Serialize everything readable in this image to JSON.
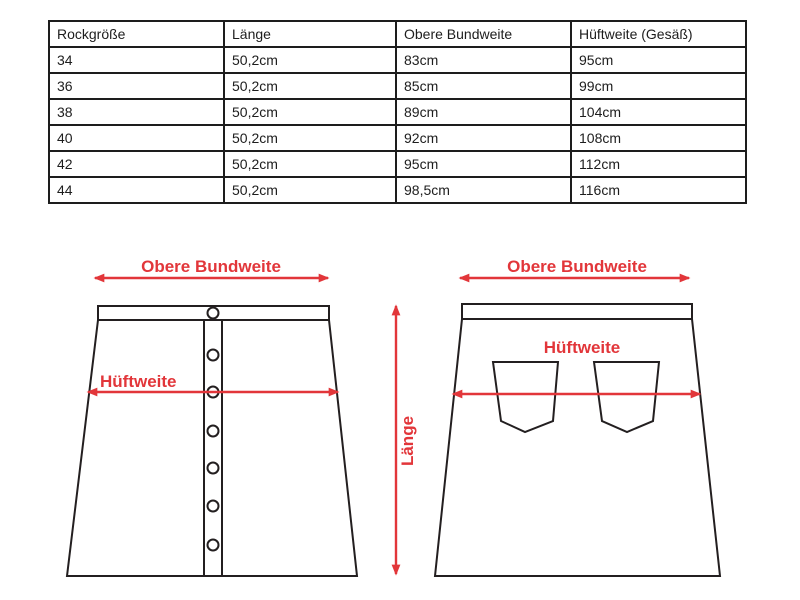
{
  "size_table": {
    "headers": [
      "Rockgröße",
      "Länge",
      "Obere Bundweite",
      "Hüftweite (Gesäß)"
    ],
    "rows": [
      [
        "34",
        "50,2cm",
        "83cm",
        "95cm"
      ],
      [
        "36",
        "50,2cm",
        "85cm",
        "99cm"
      ],
      [
        "38",
        "50,2cm",
        "89cm",
        "104cm"
      ],
      [
        "40",
        "50,2cm",
        "92cm",
        "108cm"
      ],
      [
        "42",
        "50,2cm",
        "95cm",
        "112cm"
      ],
      [
        "44",
        "50,2cm",
        "98,5cm",
        "116cm"
      ]
    ]
  },
  "diagrams": {
    "front_skirt": {
      "top_arrow_label": "Obere Bundweite",
      "hip_arrow_label": "Hüftweite",
      "button_count": 7
    },
    "back_skirt": {
      "top_arrow_label": "Obere Bundweite",
      "hip_arrow_label": "Hüftweite",
      "length_arrow_label": "Länge",
      "pocket_count": 2
    }
  },
  "colors": {
    "accent_red": "#e2363a",
    "line_black": "#231f20"
  }
}
